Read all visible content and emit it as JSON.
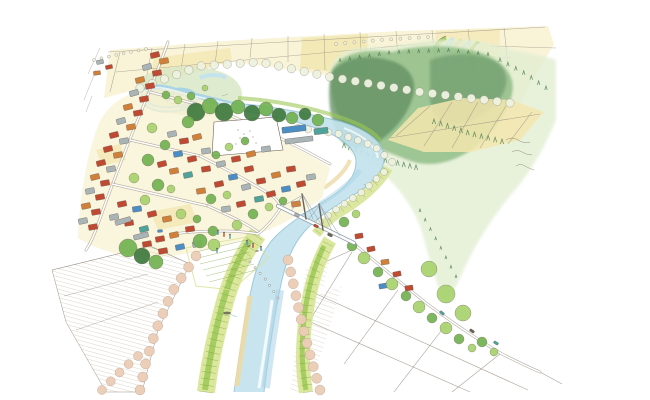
{
  "scene": {
    "medium": "pen and watercolor sketch",
    "view": "aerial oblique illustration of a meandering river town with bridge, levees, rice fields and forested hill"
  },
  "palette": {
    "paper": "#ffffff",
    "ink": "#6b6257",
    "inkLight": "#9a9184",
    "river": "#c3e3ee",
    "riverEdge": "#8fc3d8",
    "riverDeep": "#a9d4e5",
    "sand": "#ecd9a4",
    "fieldCream": "#f9f2d4",
    "fieldYellow": "#f3e6ae",
    "fieldGold": "#efe09a",
    "wetland": "#d9e8c5",
    "forestWash": "#e3efd3",
    "forestMid": "#8cba83",
    "forestDark": "#5d8c5f",
    "coniferInk": "#4a7a50",
    "leveeGreen": "#d6e492",
    "leveeBright": "#9cc857",
    "leveeLine": "#7ba23e",
    "treeLight": "#a8d36d",
    "treeMid": "#72b351",
    "treeDark": "#3f7a3e",
    "roofRed": "#c04a31",
    "roofOrange": "#d08038",
    "roofBlue": "#4b8ec5",
    "roofTeal": "#4fa39b",
    "roofGray": "#a9b4b6",
    "pink": "#eccdb6",
    "pinkStroke": "#b59a89",
    "rowTreeFill": "#eef3e0",
    "hatch": "#b8ab8e",
    "roadCasing": "#9b9285",
    "bridge": "#8d9aa8"
  },
  "houses": [
    [
      155,
      55,
      -14,
      "roofRed"
    ],
    [
      164,
      61,
      -10,
      "roofOrange"
    ],
    [
      147,
      67,
      -16,
      "roofGray"
    ],
    [
      157,
      73,
      -10,
      "roofRed"
    ],
    [
      140,
      80,
      -14,
      "roofOrange"
    ],
    [
      150,
      86,
      -10,
      "roofRed"
    ],
    [
      134,
      93,
      -16,
      "roofGray"
    ],
    [
      144,
      99,
      -10,
      "roofRed"
    ],
    [
      128,
      107,
      -14,
      "roofOrange"
    ],
    [
      138,
      113,
      -10,
      "roofRed"
    ],
    [
      121,
      121,
      -16,
      "roofGray"
    ],
    [
      131,
      127,
      -10,
      "roofOrange"
    ],
    [
      114,
      135,
      -14,
      "roofRed"
    ],
    [
      124,
      141,
      -10,
      "roofGray"
    ],
    [
      108,
      149,
      -14,
      "roofRed"
    ],
    [
      118,
      155,
      -10,
      "roofOrange"
    ],
    [
      101,
      163,
      -14,
      "roofRed"
    ],
    [
      111,
      169,
      -10,
      "roofGray"
    ],
    [
      95,
      177,
      -14,
      "roofOrange"
    ],
    [
      105,
      183,
      -10,
      "roofRed"
    ],
    [
      90,
      191,
      -12,
      "roofGray"
    ],
    [
      100,
      197,
      -10,
      "roofRed"
    ],
    [
      86,
      206,
      -12,
      "roofOrange"
    ],
    [
      96,
      212,
      -10,
      "roofRed"
    ],
    [
      83,
      221,
      -12,
      "roofGray"
    ],
    [
      93,
      227,
      -10,
      "roofRed"
    ],
    [
      100,
      62,
      -10,
      "roofGray",
      7,
      4
    ],
    [
      109,
      67,
      -12,
      "roofRed",
      7,
      4
    ],
    [
      97,
      73,
      -8,
      "roofOrange",
      7,
      4
    ],
    [
      172,
      134,
      -12,
      "roofGray"
    ],
    [
      184,
      141,
      -8,
      "roofRed"
    ],
    [
      197,
      137,
      -14,
      "roofOrange"
    ],
    [
      178,
      154,
      -10,
      "roofBlue"
    ],
    [
      192,
      159,
      -12,
      "roofRed"
    ],
    [
      206,
      151,
      -8,
      "roofGray"
    ],
    [
      162,
      164,
      -14,
      "roofRed"
    ],
    [
      174,
      171,
      -10,
      "roofOrange"
    ],
    [
      188,
      175,
      -12,
      "roofTeal"
    ],
    [
      206,
      169,
      -8,
      "roofRed"
    ],
    [
      221,
      164,
      -12,
      "roofGray"
    ],
    [
      236,
      159,
      -10,
      "roofRed"
    ],
    [
      251,
      154,
      -14,
      "roofOrange"
    ],
    [
      266,
      149,
      -8,
      "roofGray"
    ],
    [
      249,
      169,
      -12,
      "roofRed"
    ],
    [
      233,
      177,
      -10,
      "roofBlue"
    ],
    [
      219,
      184,
      -12,
      "roofRed"
    ],
    [
      201,
      191,
      -8,
      "roofOrange"
    ],
    [
      246,
      187,
      -14,
      "roofGray"
    ],
    [
      261,
      181,
      -10,
      "roofRed"
    ],
    [
      276,
      175,
      -12,
      "roofOrange"
    ],
    [
      291,
      169,
      -8,
      "roofRed"
    ],
    [
      259,
      199,
      -10,
      "roofTeal"
    ],
    [
      241,
      204,
      -12,
      "roofRed"
    ],
    [
      226,
      209,
      -8,
      "roofGray"
    ],
    [
      271,
      194,
      -14,
      "roofRed"
    ],
    [
      286,
      189,
      -10,
      "roofBlue"
    ],
    [
      301,
      184,
      -12,
      "roofRed"
    ],
    [
      296,
      204,
      -8,
      "roofOrange"
    ],
    [
      311,
      177,
      -10,
      "roofGray"
    ],
    [
      122,
      204,
      -12,
      "roofRed"
    ],
    [
      137,
      209,
      -8,
      "roofBlue"
    ],
    [
      152,
      214,
      -14,
      "roofRed"
    ],
    [
      167,
      219,
      -10,
      "roofOrange"
    ],
    [
      114,
      217,
      -12,
      "roofGray"
    ],
    [
      129,
      223,
      -8,
      "roofRed"
    ],
    [
      144,
      229,
      -14,
      "roofTeal"
    ],
    [
      160,
      239,
      -10,
      "roofRed"
    ],
    [
      174,
      235,
      -12,
      "roofOrange"
    ],
    [
      190,
      229,
      -8,
      "roofRed"
    ],
    [
      180,
      247,
      -12,
      "roofBlue"
    ],
    [
      163,
      251,
      -10,
      "roofRed"
    ],
    [
      197,
      244,
      -14,
      "roofGray"
    ],
    [
      147,
      244,
      -10,
      "roofRed"
    ],
    [
      123,
      221,
      -16,
      "roofGray",
      16,
      5
    ],
    [
      141,
      236,
      -14,
      "roofGray",
      15,
      5
    ],
    [
      294,
      129,
      -7,
      "roofBlue",
      24,
      6
    ],
    [
      299,
      140,
      -7,
      "roofGray",
      28,
      5
    ],
    [
      321,
      131,
      -7,
      "roofTeal",
      14,
      6
    ],
    [
      359,
      236,
      -10,
      "roofRed",
      8,
      5
    ],
    [
      371,
      249,
      -12,
      "roofRed",
      8,
      5
    ],
    [
      385,
      262,
      -8,
      "roofOrange",
      8,
      5
    ],
    [
      397,
      274,
      -12,
      "roofRed",
      8,
      5
    ],
    [
      383,
      286,
      -10,
      "roofBlue",
      8,
      5
    ],
    [
      409,
      288,
      -8,
      "roofRed",
      8,
      5
    ]
  ],
  "trees": [
    [
      196,
      112,
      9,
      "treeDark"
    ],
    [
      210,
      106,
      8,
      "treeMid"
    ],
    [
      224,
      112,
      9,
      "treeDark"
    ],
    [
      238,
      107,
      7,
      "treeMid"
    ],
    [
      252,
      113,
      8,
      "treeDark"
    ],
    [
      266,
      109,
      7,
      "treeMid"
    ],
    [
      279,
      115,
      7,
      "treeDark"
    ],
    [
      188,
      122,
      6,
      "treeMid"
    ],
    [
      292,
      118,
      6,
      "treeMid"
    ],
    [
      305,
      114,
      6,
      "treeDark"
    ],
    [
      318,
      120,
      6,
      "treeMid"
    ],
    [
      152,
      128,
      5,
      "treeLight"
    ],
    [
      165,
      145,
      5,
      "treeMid"
    ],
    [
      148,
      160,
      6,
      "treeMid"
    ],
    [
      134,
      178,
      5,
      "treeLight"
    ],
    [
      158,
      185,
      6,
      "treeMid"
    ],
    [
      145,
      200,
      5,
      "treeLight"
    ],
    [
      128,
      248,
      9,
      "treeMid"
    ],
    [
      142,
      256,
      8,
      "treeDark"
    ],
    [
      156,
      262,
      7,
      "treeMid"
    ],
    [
      171,
      189,
      4,
      "treeLight"
    ],
    [
      216,
      155,
      4,
      "treeMid"
    ],
    [
      229,
      147,
      4,
      "treeLight"
    ],
    [
      245,
      141,
      4,
      "treeMid"
    ],
    [
      211,
      199,
      5,
      "treeMid"
    ],
    [
      227,
      195,
      4,
      "treeLight"
    ],
    [
      253,
      214,
      5,
      "treeMid"
    ],
    [
      269,
      207,
      4,
      "treeLight"
    ],
    [
      283,
      201,
      4,
      "treeMid"
    ],
    [
      181,
      214,
      5,
      "treeLight"
    ],
    [
      197,
      219,
      4,
      "treeMid"
    ],
    [
      237,
      225,
      5,
      "treeLight"
    ],
    [
      213,
      231,
      5,
      "treeMid"
    ],
    [
      200,
      241,
      7,
      "treeMid"
    ],
    [
      214,
      245,
      6,
      "treeLight"
    ],
    [
      166,
      95,
      4,
      "treeMid"
    ],
    [
      178,
      100,
      4,
      "treeLight"
    ],
    [
      191,
      96,
      4,
      "treeMid"
    ],
    [
      205,
      88,
      3,
      "treeLight"
    ],
    [
      352,
      246,
      5,
      "treeMid"
    ],
    [
      364,
      258,
      6,
      "treeLight"
    ],
    [
      378,
      272,
      5,
      "treeMid"
    ],
    [
      392,
      284,
      6,
      "treeLight"
    ],
    [
      406,
      296,
      5,
      "treeMid"
    ],
    [
      419,
      307,
      6,
      "treeLight"
    ],
    [
      432,
      318,
      5,
      "treeMid"
    ],
    [
      446,
      328,
      6,
      "treeLight"
    ],
    [
      459,
      339,
      5,
      "treeMid"
    ],
    [
      472,
      348,
      4,
      "treeLight"
    ],
    [
      429,
      269,
      8,
      "treeLight"
    ],
    [
      446,
      294,
      9,
      "treeLight"
    ],
    [
      463,
      313,
      8,
      "treeLight"
    ],
    [
      482,
      342,
      5,
      "treeMid"
    ],
    [
      494,
      352,
      4,
      "treeLight"
    ],
    [
      344,
      222,
      5,
      "treeMid"
    ],
    [
      356,
      214,
      4,
      "treeLight"
    ]
  ],
  "treeRows": [
    {
      "path": [
        [
          140,
          88
        ],
        [
          200,
          66
        ],
        [
          260,
          62
        ],
        [
          330,
          77
        ],
        [
          420,
          92
        ],
        [
          510,
          103
        ]
      ],
      "count": 30,
      "r": 4.2,
      "fill": "rowTreeFill",
      "stroke": "inkLight"
    },
    {
      "path": [
        [
          298,
          128
        ],
        [
          340,
          134
        ],
        [
          374,
          146
        ],
        [
          392,
          162
        ]
      ],
      "count": 11,
      "r": 3.6,
      "fill": "rowTreeFill",
      "stroke": "inkLight"
    },
    {
      "path": [
        [
          384,
          172
        ],
        [
          362,
          192
        ],
        [
          338,
          208
        ],
        [
          320,
          222
        ]
      ],
      "count": 9,
      "r": 3.4,
      "fill": "rowTreeFill",
      "stroke": "inkLight"
    },
    {
      "path": [
        [
          196,
          256
        ],
        [
          172,
          292
        ],
        [
          156,
          330
        ],
        [
          146,
          362
        ],
        [
          140,
          390
        ]
      ],
      "count": 12,
      "r": 5,
      "fill": "pink",
      "stroke": "pinkStroke"
    },
    {
      "path": [
        [
          288,
          260
        ],
        [
          296,
          296
        ],
        [
          304,
          332
        ],
        [
          312,
          362
        ],
        [
          320,
          390
        ]
      ],
      "count": 12,
      "r": 5,
      "fill": "pink",
      "stroke": "pinkStroke"
    },
    {
      "path": [
        [
          138,
          356
        ],
        [
          124,
          368
        ],
        [
          112,
          380
        ],
        [
          102,
          390
        ]
      ],
      "count": 5,
      "r": 4.5,
      "fill": "pink",
      "stroke": "pinkStroke"
    },
    {
      "path": [
        [
          336,
          44
        ],
        [
          380,
          40
        ],
        [
          428,
          37
        ]
      ],
      "count": 11,
      "r": 1.6,
      "fill": "rowTreeFill",
      "stroke": "inkLight"
    },
    {
      "path": [
        [
          94,
          60
        ],
        [
          120,
          54
        ],
        [
          146,
          49
        ]
      ],
      "count": 8,
      "r": 1.5,
      "fill": "rowTreeFill",
      "stroke": "inkLight"
    }
  ],
  "stones": {
    "path": [
      [
        250,
        262
      ],
      [
        266,
        280
      ],
      [
        278,
        298
      ]
    ],
    "count": 7,
    "r": 1.1
  },
  "tickRows": [
    {
      "path": [
        [
          256,
          236
        ],
        [
          240,
          260
        ],
        [
          228,
          292
        ],
        [
          218,
          330
        ],
        [
          210,
          364
        ],
        [
          206,
          392
        ]
      ],
      "count": 26,
      "len": 14
    },
    {
      "path": [
        [
          328,
          244
        ],
        [
          314,
          272
        ],
        [
          307,
          304
        ],
        [
          304,
          340
        ],
        [
          305,
          370
        ],
        [
          308,
          392
        ]
      ],
      "count": 22,
      "len": 11
    },
    {
      "path": [
        [
          386,
          170
        ],
        [
          368,
          190
        ],
        [
          348,
          204
        ],
        [
          330,
          216
        ],
        [
          318,
          232
        ]
      ],
      "count": 12,
      "len": 8
    }
  ],
  "spikeRows": [
    {
      "path": [
        [
          344,
          148
        ],
        [
          382,
          162
        ],
        [
          416,
          170
        ]
      ],
      "count": 13,
      "s": 1
    },
    {
      "path": [
        [
          434,
          124
        ],
        [
          470,
          136
        ],
        [
          502,
          144
        ]
      ],
      "count": 11,
      "s": 1
    },
    {
      "path": [
        [
          340,
          62
        ],
        [
          392,
          54
        ],
        [
          448,
          52
        ],
        [
          488,
          56
        ]
      ],
      "count": 16,
      "s": 0.7
    },
    {
      "path": [
        [
          500,
          62
        ],
        [
          526,
          76
        ],
        [
          546,
          90
        ]
      ],
      "count": 7,
      "s": 0.8
    },
    {
      "path": [
        [
          420,
          212
        ],
        [
          440,
          248
        ],
        [
          456,
          278
        ]
      ],
      "count": 8,
      "s": 0.6
    }
  ],
  "fieldLines": {
    "top": [
      [
        110,
        92,
        120,
        52
      ],
      [
        145,
        86,
        152,
        48
      ],
      [
        180,
        76,
        185,
        44
      ],
      [
        215,
        64,
        218,
        41
      ],
      [
        250,
        58,
        252,
        38
      ],
      [
        288,
        62,
        288,
        36
      ],
      [
        325,
        70,
        324,
        34
      ],
      [
        362,
        76,
        360,
        32
      ],
      [
        400,
        84,
        396,
        31
      ],
      [
        438,
        90,
        432,
        30
      ],
      [
        476,
        96,
        468,
        29
      ],
      [
        512,
        102,
        504,
        28
      ],
      [
        108,
        52,
        545,
        27
      ],
      [
        116,
        72,
        440,
        42
      ]
    ],
    "hillside": [
      [
        396,
        136,
        430,
        106
      ],
      [
        424,
        146,
        452,
        102
      ],
      [
        452,
        148,
        478,
        102
      ],
      [
        480,
        148,
        506,
        106
      ],
      [
        508,
        144,
        532,
        112
      ],
      [
        390,
        138,
        540,
        114
      ]
    ],
    "bottomRight": [
      [
        316,
        266,
        352,
        250
      ],
      [
        312,
        292,
        528,
        390
      ],
      [
        306,
        320,
        470,
        392
      ],
      [
        352,
        252,
        310,
        320
      ],
      [
        398,
        290,
        344,
        364
      ],
      [
        448,
        322,
        394,
        392
      ],
      [
        500,
        354,
        452,
        392
      ],
      [
        540,
        372,
        562,
        384
      ]
    ],
    "bottomLeft": [
      [
        52,
        270,
        150,
        246
      ],
      [
        150,
        246,
        190,
        264
      ],
      [
        64,
        296,
        148,
        274
      ],
      [
        76,
        330,
        158,
        302
      ]
    ],
    "sketch": [
      [
        88,
        74,
        100,
        48
      ],
      [
        84,
        100,
        96,
        70
      ],
      [
        86,
        112,
        92,
        96
      ],
      [
        490,
        46,
        556,
        48
      ],
      [
        455,
        54,
        512,
        58
      ]
    ]
  },
  "people": [
    [
      218,
      233,
      "roofBlue"
    ],
    [
      224,
      235,
      "roofRed"
    ],
    [
      230,
      237,
      "roofTeal"
    ],
    [
      247,
      243,
      "roofBlue"
    ],
    [
      253,
      246,
      "roofRed"
    ],
    [
      217,
      251,
      "roofTeal"
    ],
    [
      261,
      249,
      "roofBlue"
    ]
  ],
  "cars": [
    [
      297,
      215,
      25,
      "roofGray"
    ],
    [
      316,
      226,
      25,
      "roofRed"
    ],
    [
      330,
      235,
      25,
      "ink"
    ],
    [
      442,
      313,
      38,
      "roofTeal"
    ],
    [
      472,
      331,
      33,
      "ink"
    ],
    [
      496,
      343,
      30,
      "roofTeal"
    ],
    [
      160,
      231,
      -5,
      "roofBlue"
    ]
  ],
  "benches": [
    [
      249,
      246
    ],
    [
      257,
      251
    ]
  ],
  "boat": {
    "x": 227,
    "y": 313
  }
}
